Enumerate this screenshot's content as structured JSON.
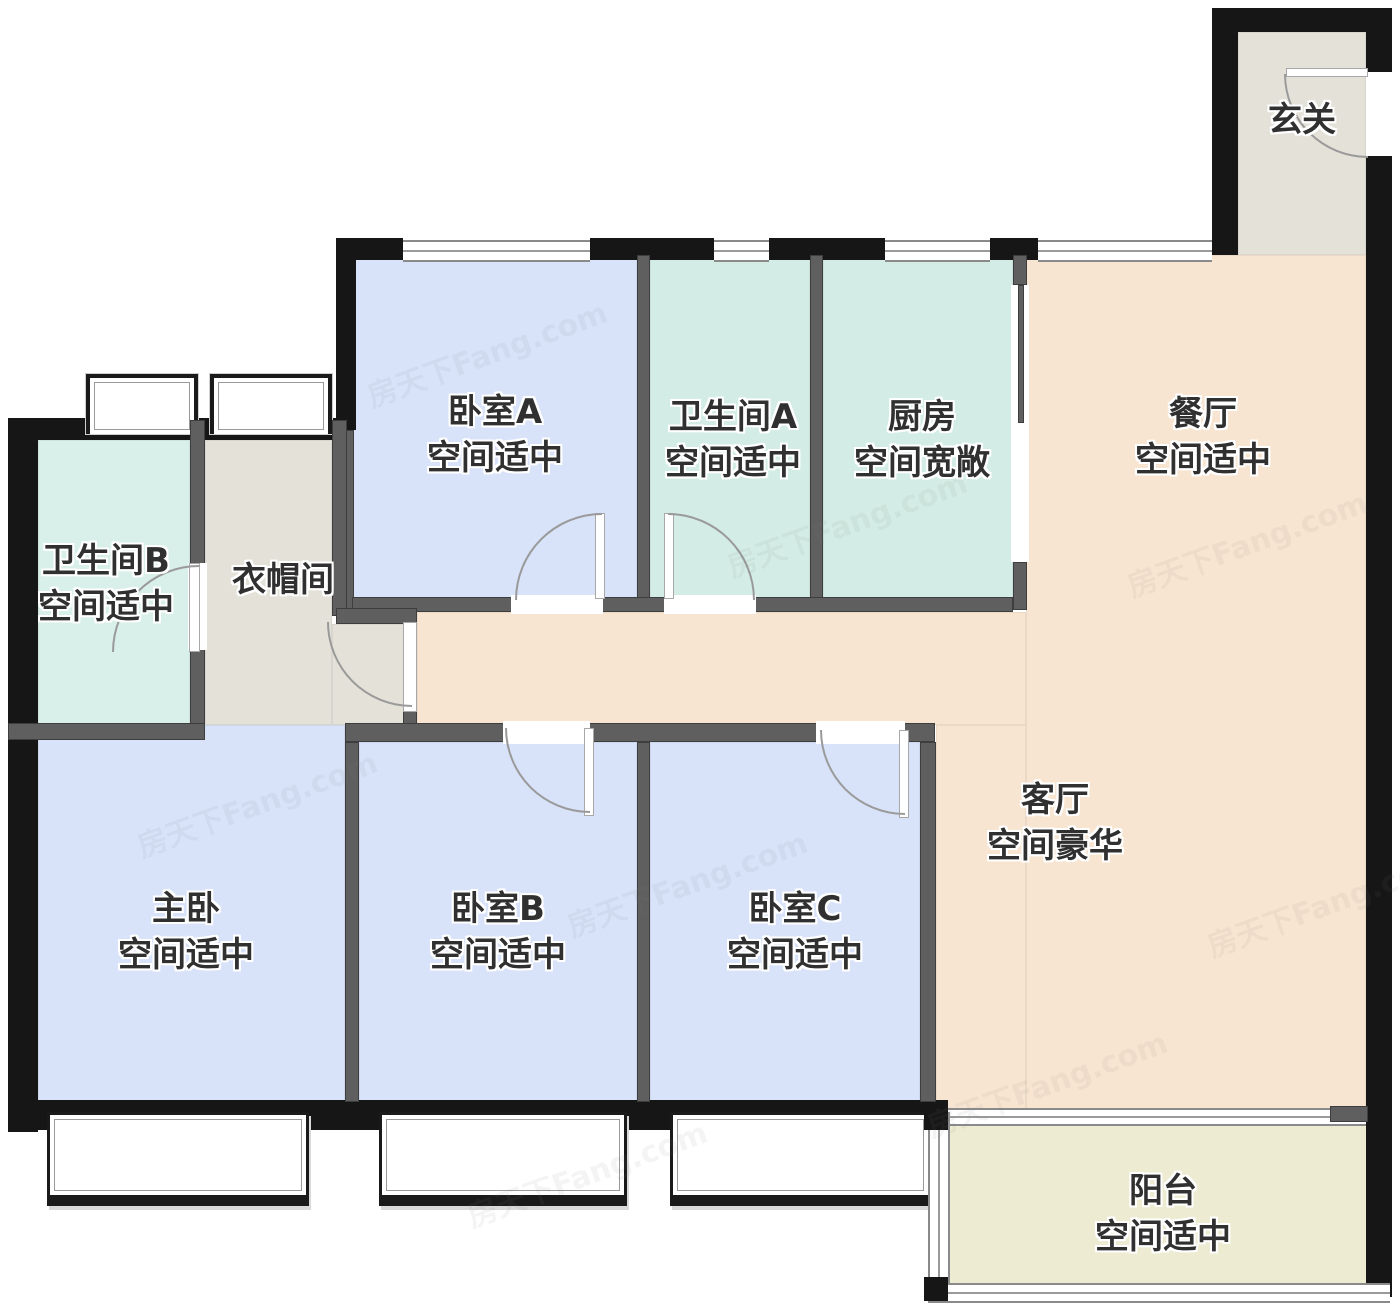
{
  "watermark": {
    "text": "房天下Fang.com"
  },
  "palette": {
    "exterior_wall": "#161616",
    "interior_wall": "#5f5f5f",
    "door_arc": "#9a9a9a",
    "window_line": "#8a8a8a",
    "label_text": "#303030"
  },
  "rooms": {
    "xuanguan": {
      "name": "玄关",
      "desc": "",
      "color": "#e3e1d8"
    },
    "canting": {
      "name": "餐厅",
      "desc": "空间适中",
      "color": "#f7e5d1"
    },
    "woshi_a": {
      "name": "卧室A",
      "desc": "空间适中",
      "color": "#d8e3f9"
    },
    "weishengjian_a": {
      "name": "卫生间A",
      "desc": "空间适中",
      "color": "#d3ece5"
    },
    "chufang": {
      "name": "厨房",
      "desc": "空间宽敞",
      "color": "#d3ece5"
    },
    "weishengjian_b": {
      "name": "卫生间B",
      "desc": "空间适中",
      "color": "#d9efe9"
    },
    "yimaojian": {
      "name": "衣帽间",
      "desc": "",
      "color": "#e3e1d8"
    },
    "zhuwo": {
      "name": "主卧",
      "desc": "空间适中",
      "color": "#d8e3f9"
    },
    "woshi_b": {
      "name": "卧室B",
      "desc": "空间适中",
      "color": "#d8e3f9"
    },
    "woshi_c": {
      "name": "卧室C",
      "desc": "空间适中",
      "color": "#d8e3f9"
    },
    "keting": {
      "name": "客厅",
      "desc": "空间豪华",
      "color": "#f7e5d1"
    },
    "yangtai": {
      "name": "阳台",
      "desc": "空间适中",
      "color": "#edebd2"
    }
  }
}
